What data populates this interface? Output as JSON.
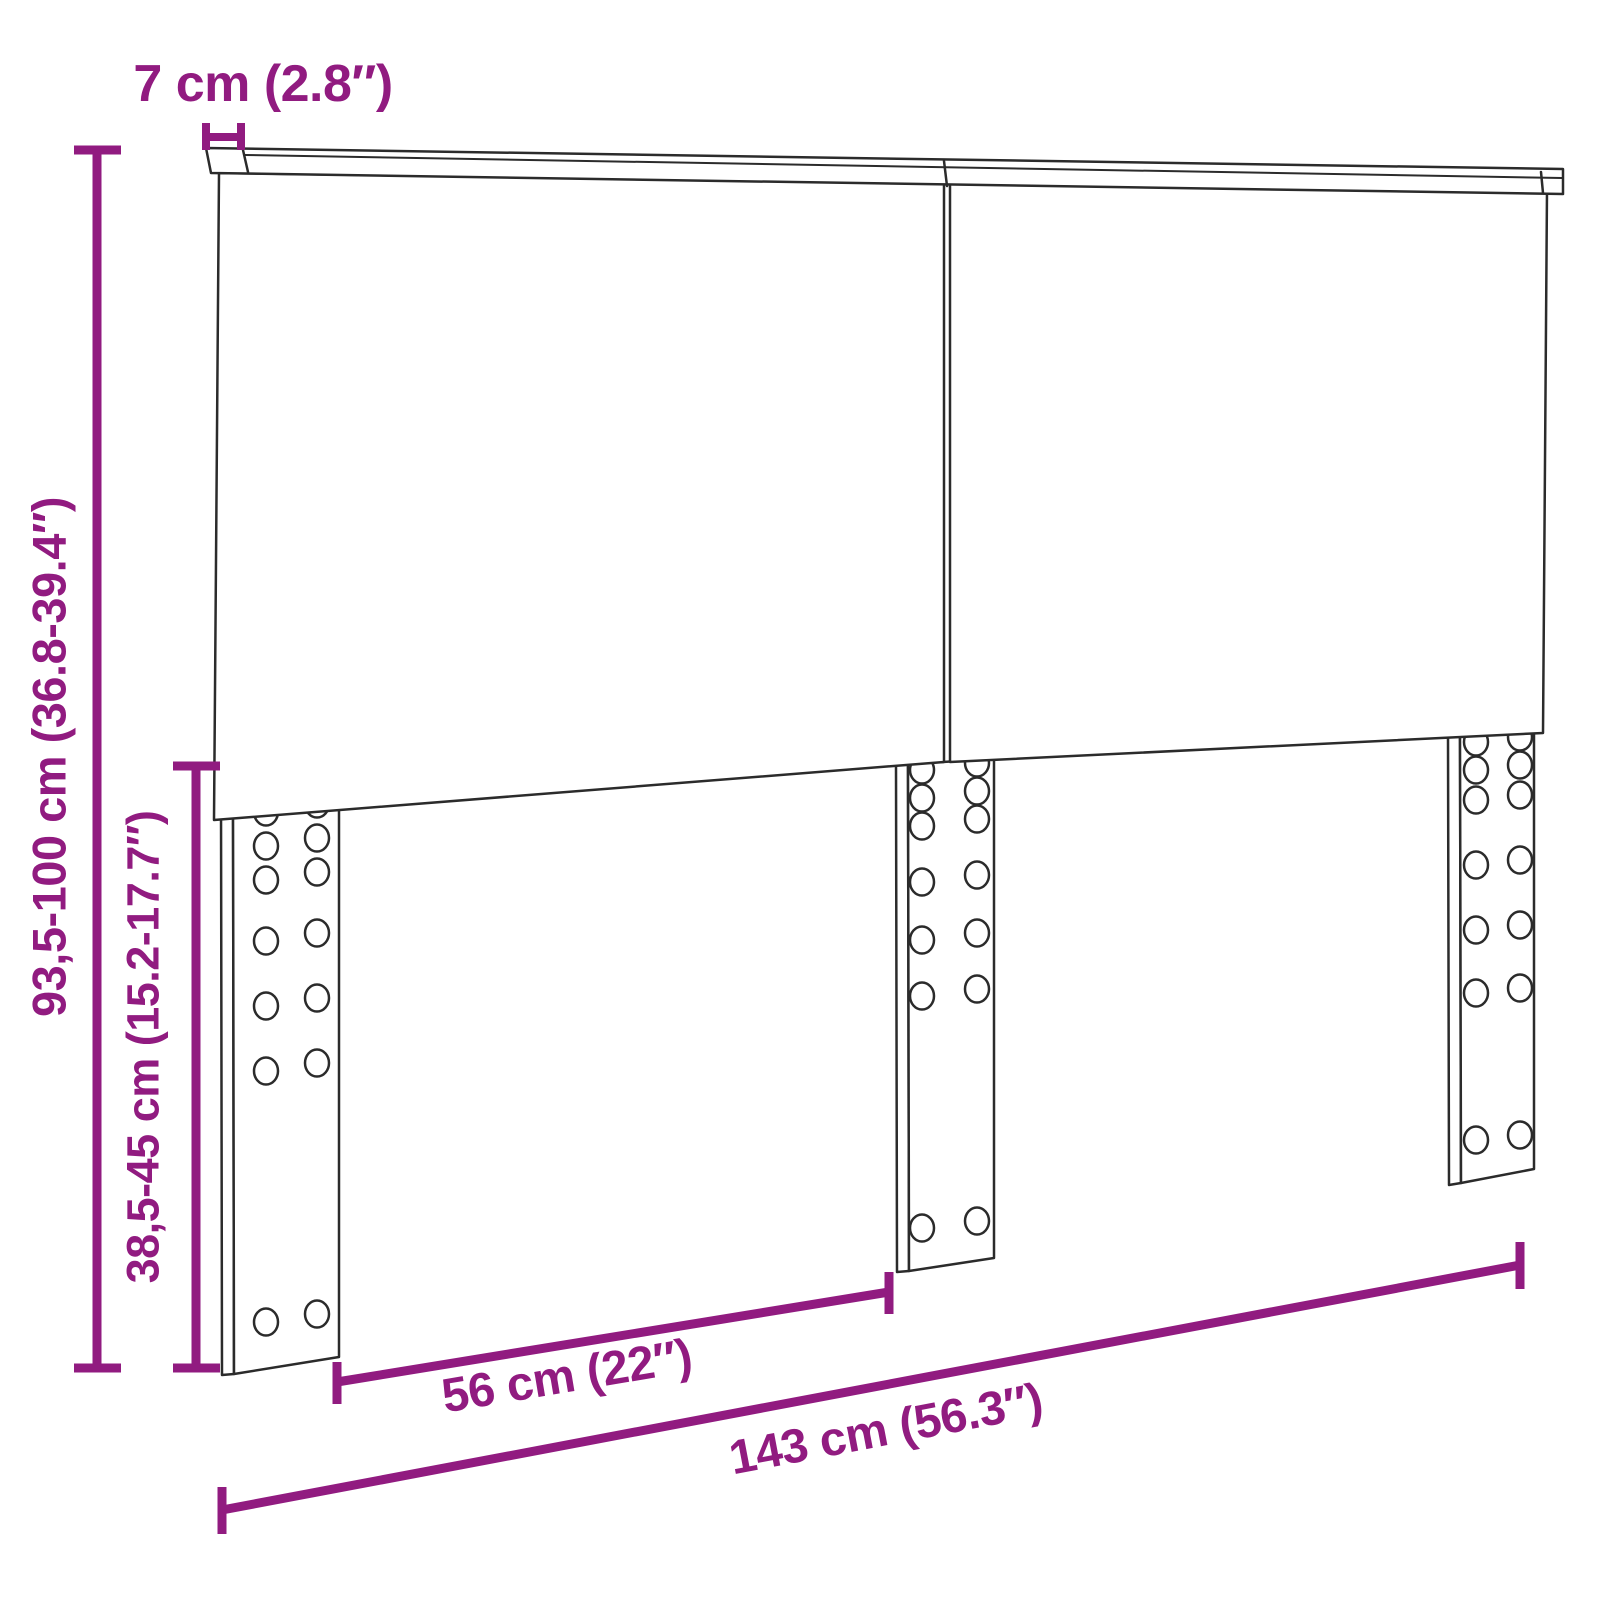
{
  "canvas": {
    "background": "#ffffff"
  },
  "drawing": {
    "outline_color": "#2b2b2b",
    "accent_color": "#911b80"
  },
  "dimensions": {
    "rail_thickness": "7 cm (2.8″)",
    "total_height": "93,5-100 cm (36.8-39.4″)",
    "leg_height": "38,5-45 cm (15.2-17.7″)",
    "leg_gap": "56 cm (22″)",
    "total_width": "143 cm (56.3″)"
  }
}
